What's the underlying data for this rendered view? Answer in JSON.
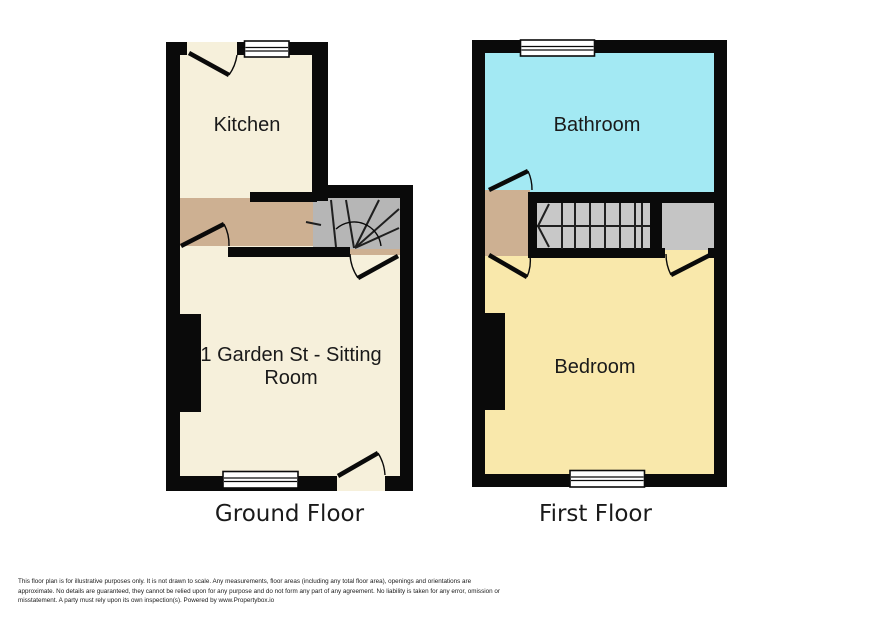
{
  "plans": {
    "ground": {
      "label": "Ground Floor",
      "kitchen_label": "Kitchen",
      "sitting_line1": "1 Garden St - Sitting",
      "sitting_line2": "Room"
    },
    "first": {
      "label": "First Floor",
      "bathroom_label": "Bathroom",
      "bedroom_label": "Bedroom"
    }
  },
  "colors": {
    "wall": "#0a0a0a",
    "room_cream": "#f6f0db",
    "hall_tan": "#cdb092",
    "stair_gray_ground": "#b6b6b6",
    "stair_gray_first": "#c8c8c8",
    "cupboard_gray": "#c5c5c5",
    "bathroom_cyan": "#a3e9f3",
    "bedroom_yellow": "#f9e8ab",
    "text": "#1a1a1a"
  },
  "footer": {
    "line1": "This floor plan is for illustrative purposes only. It is not drawn to scale. Any measurements, floor areas (including any total floor area), openings and orientations are",
    "line2": "approximate. No details are guaranteed, they cannot be relied upon for any purpose and do not form any part of any agreement. No liability is taken for any error, omission or",
    "line3": "misstatement. A party must rely upon its own inspection(s). Powered by www.Propertybox.io"
  }
}
